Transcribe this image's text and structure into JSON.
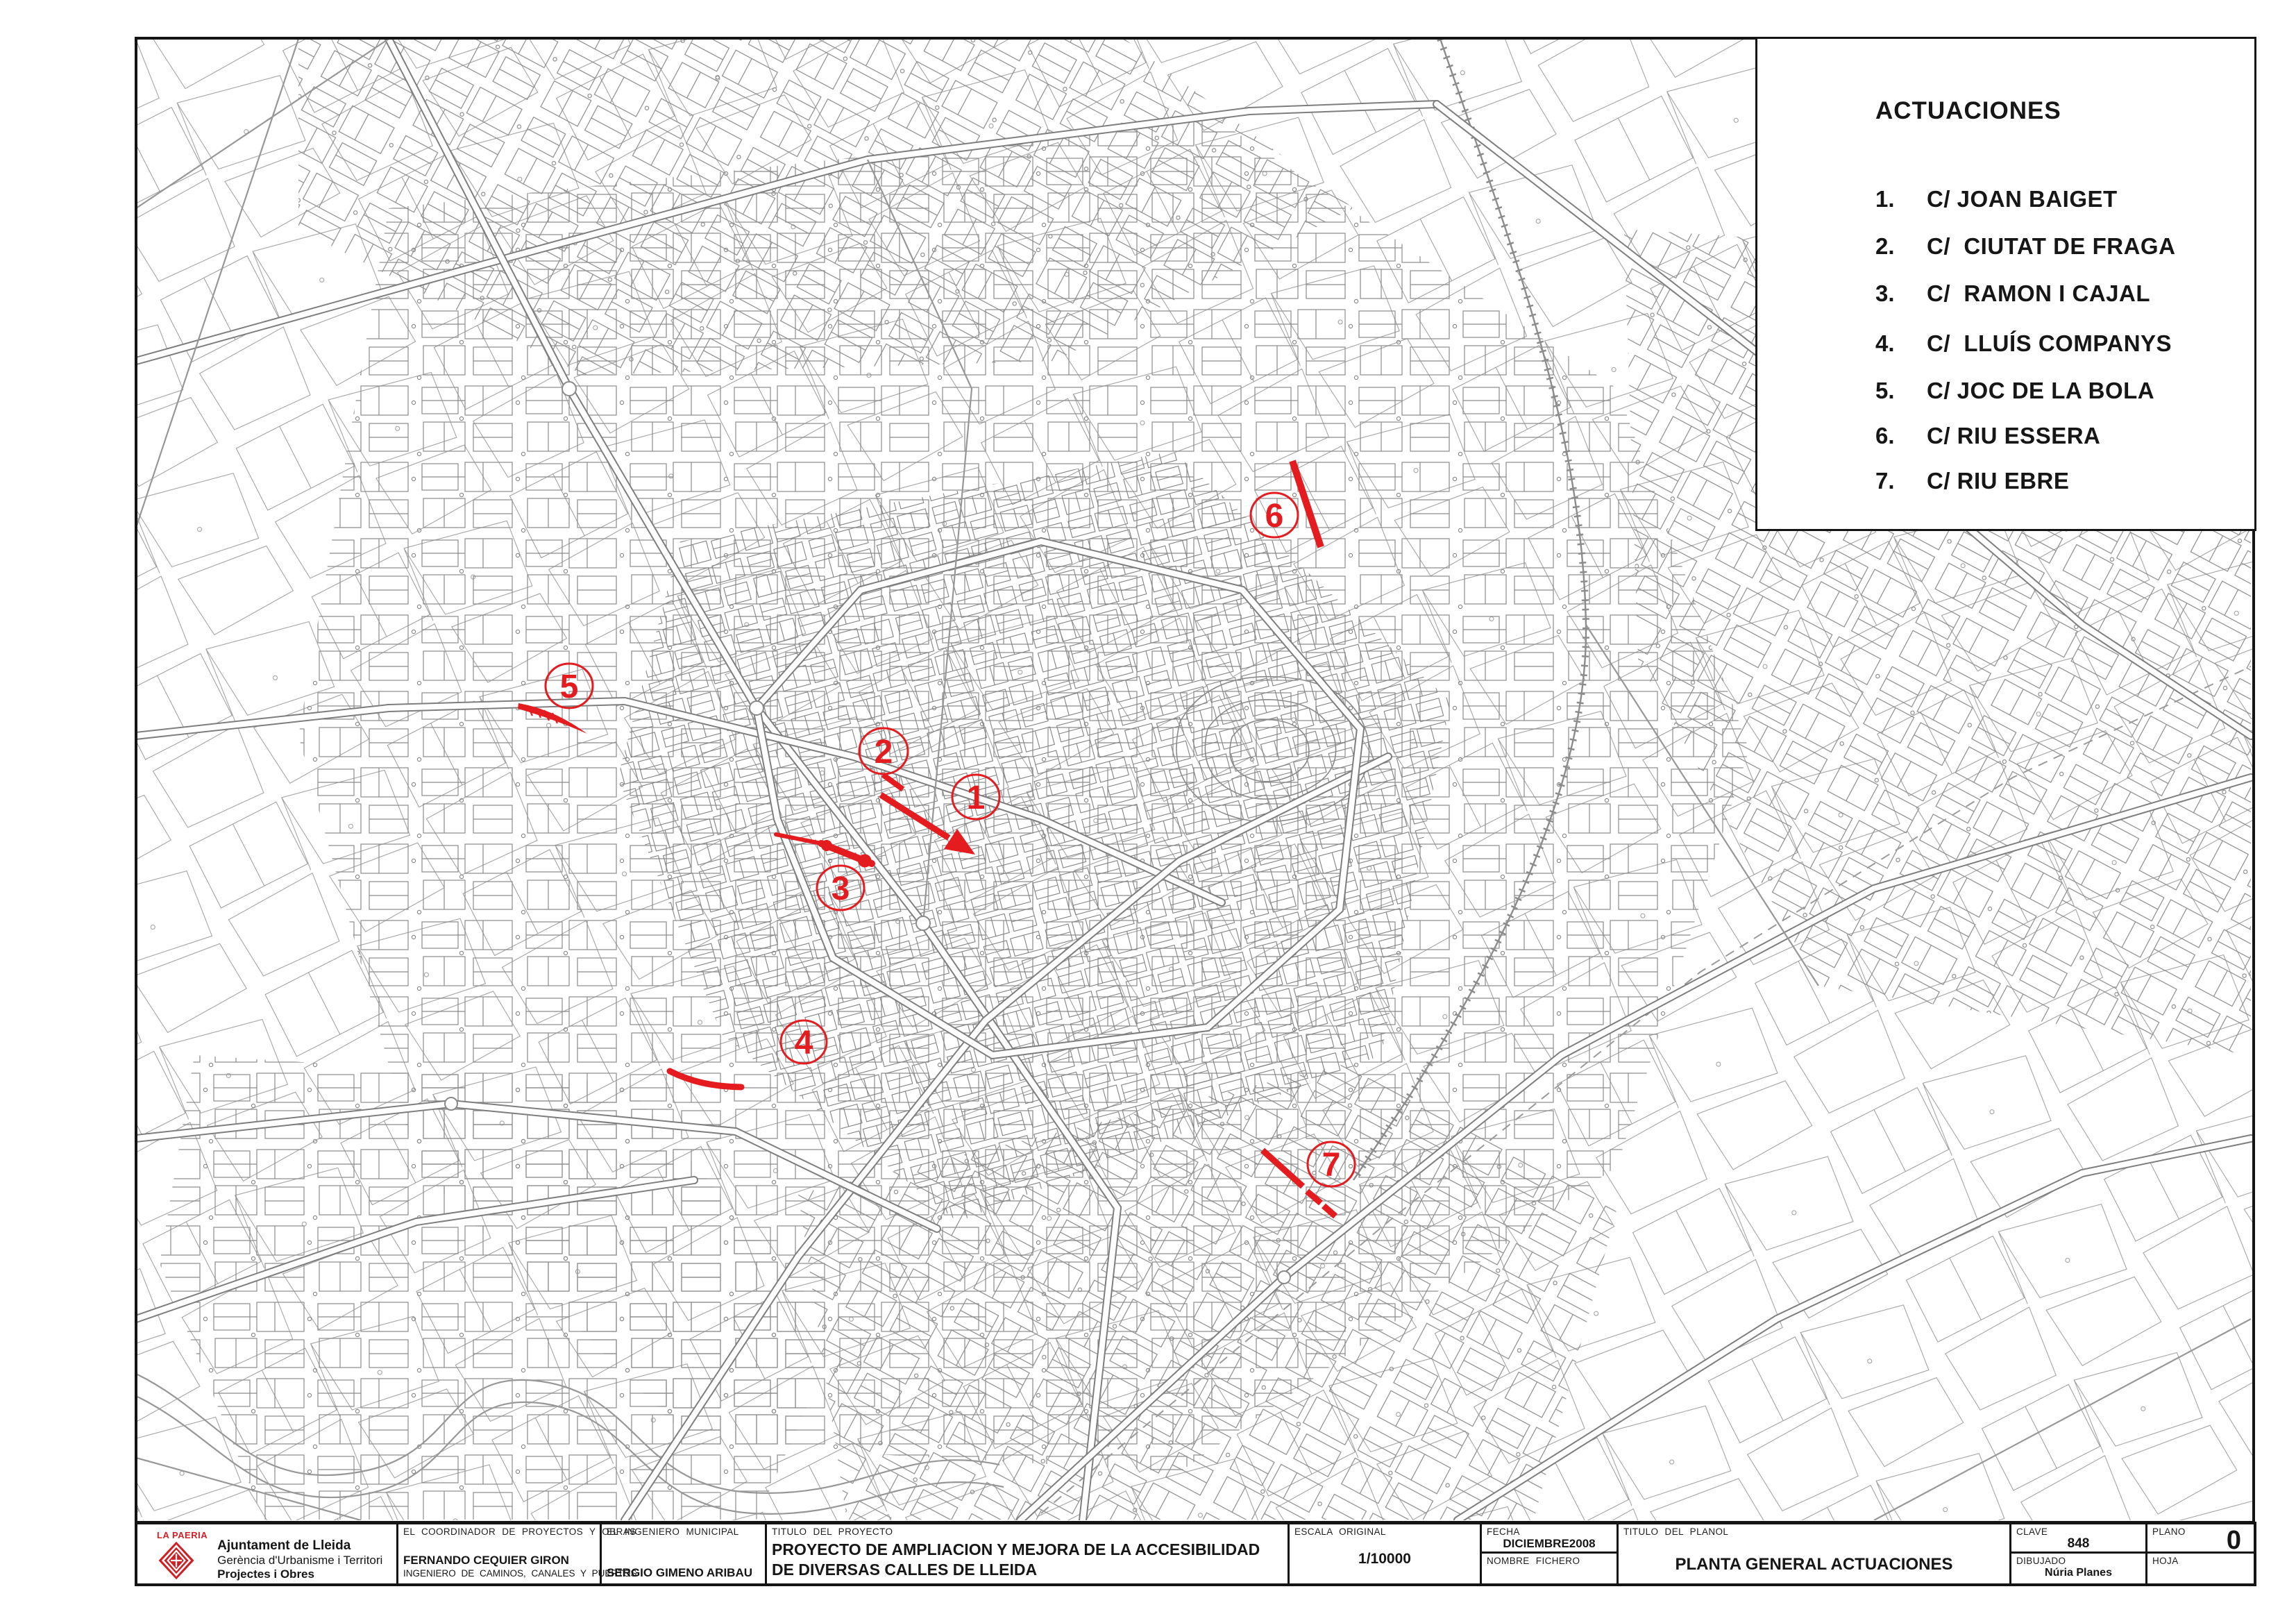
{
  "colors": {
    "accent_red": "#e41c20",
    "map_line_gray": "#8a8a8a",
    "ink": "#161616"
  },
  "legend": {
    "title": "ACTUACIONES",
    "items": [
      {
        "number": "1.",
        "name": "C/ JOAN BAIGET"
      },
      {
        "number": "2.",
        "name": "C/  CIUTAT DE FRAGA"
      },
      {
        "number": "3.",
        "name": "C/  RAMON I CAJAL"
      },
      {
        "number": "4.",
        "name": "C/  LLUÍS COMPANYS"
      },
      {
        "number": "5.",
        "name": "C/ JOC DE LA BOLA"
      },
      {
        "number": "6.",
        "name": "C/ RIU ESSERA"
      },
      {
        "number": "7.",
        "name": "C/ RIU EBRE"
      }
    ]
  },
  "map": {
    "markers": [
      {
        "number": "1"
      },
      {
        "number": "2"
      },
      {
        "number": "3"
      },
      {
        "number": "4"
      },
      {
        "number": "5"
      },
      {
        "number": "6"
      },
      {
        "number": "7"
      }
    ]
  },
  "title_block": {
    "org": {
      "brand": "LA PAERIA",
      "line1": "Ajuntament de Lleida",
      "line2": "Gerència d'Urbanisme i Territori",
      "line3": "Projectes i Obres"
    },
    "coordinator": {
      "label": "EL COORDINADOR DE PROYECTOS Y OBRAS",
      "name": "FERNANDO CEQUIER GIRON",
      "title": "INGENIERO DE CAMINOS, CANALES Y PUERTOS"
    },
    "municipal": {
      "label": "EL INGENIERO MUNICIPAL",
      "name": "SERGIO GIMENO ARIBAU"
    },
    "project": {
      "label": "TITULO DEL PROYECTO",
      "title": "PROYECTO DE AMPLIACION Y MEJORA DE LA ACCESIBILIDAD DE DIVERSAS CALLES DE LLEIDA"
    },
    "scale": {
      "label": "ESCALA ORIGINAL",
      "value": "1/10000"
    },
    "date": {
      "label": "FECHA",
      "value": "DICIEMBRE2008"
    },
    "file": {
      "label": "NOMBRE FICHERO",
      "value": ""
    },
    "plan_title": {
      "label": "TITULO DEL PLANOL",
      "value": "PLANTA GENERAL ACTUACIONES"
    },
    "key": {
      "label": "CLAVE",
      "value": "848"
    },
    "drawn": {
      "label": "DIBUJADO",
      "value": "Núria Planes"
    },
    "sheet": {
      "label": "PLANO",
      "value": "0"
    },
    "page": {
      "label": "HOJA",
      "value": ""
    }
  }
}
